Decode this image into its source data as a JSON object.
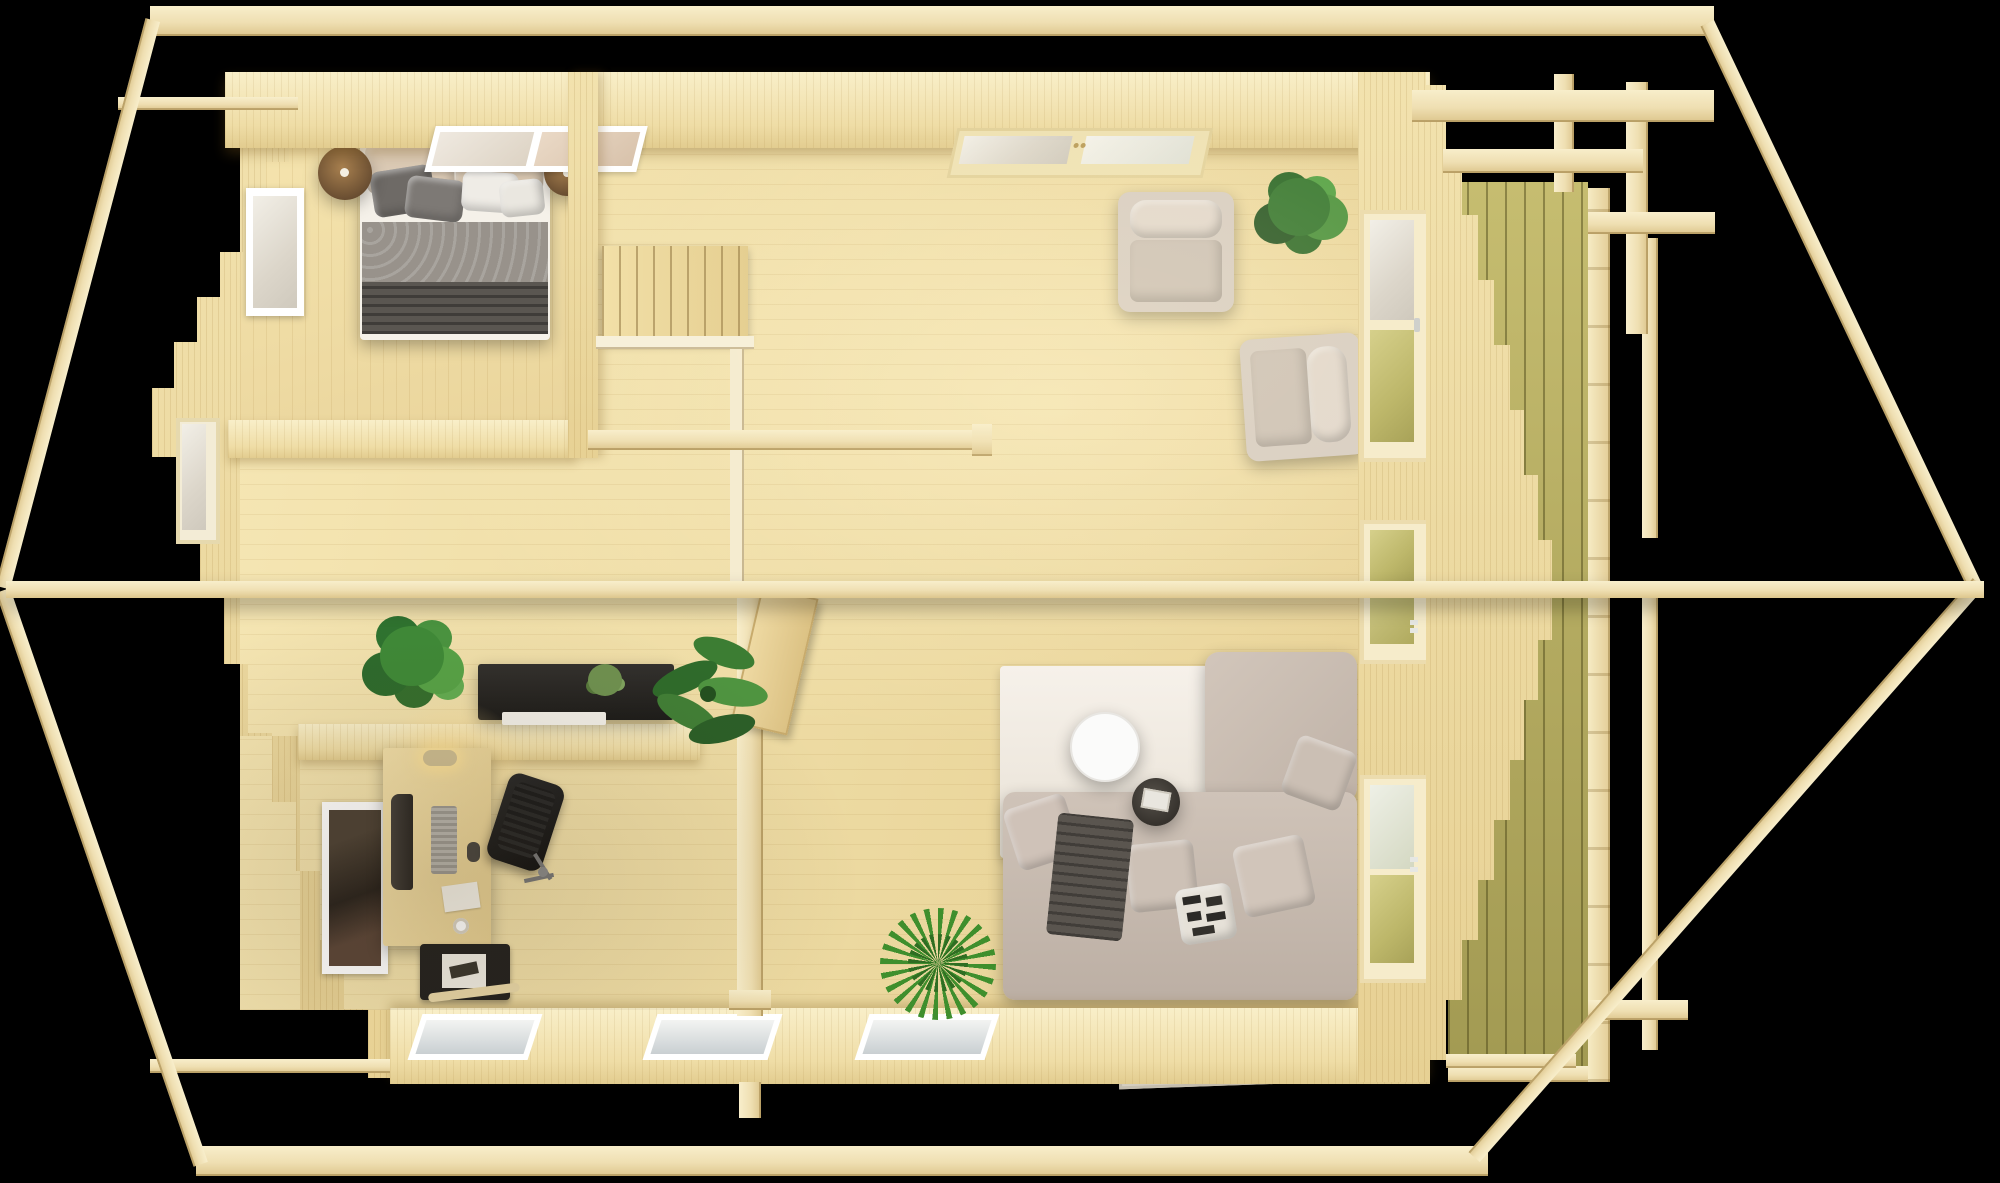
{
  "scene": {
    "title": "Top-down 3D render of a roofless wooden log cabin floor plan on a black background",
    "background_color": "#000000",
    "palette": {
      "roof_beam": "#f2e3bb",
      "wall_face": "#eedca4",
      "wall_top": "#f6ebc4",
      "floor_light": "#f6e7b5",
      "floor_dark": "#e6cf92",
      "terrace_deck_green": "#b9b164",
      "window_frame_white": "#ffffff",
      "sofa_greige": "#c9bcb1",
      "console_black": "#262626",
      "plant_green": "#3f8a38"
    },
    "rooms": {
      "bedroom": {
        "label": "Bedroom with double bed, two bedside pendant lamps, roof window"
      },
      "hallway": {
        "label": "Hallway with staircase, console sideboard and plants"
      },
      "office": {
        "label": "Home office with desk, monitor, lamp, office chair, magazine rack"
      },
      "living": {
        "label": "Living room with L-shaped sofa, rug, coffee table, two armchairs"
      },
      "terrace": {
        "label": "Covered terrace with green decking and pergola railing"
      }
    },
    "structure": {
      "roof_frame": {
        "label": "Exposed roof frame: ridge beam through the middle, top and bottom eave beams, diagonal gable rafters"
      },
      "west_gable": {
        "label": "Stepped log gable wall (left)"
      },
      "east_gable": {
        "label": "Stepped log gable wall (right, beside terrace)"
      },
      "north_wall": {
        "label": "Top wall with two double-pane windows"
      },
      "south_wall": {
        "label": "Bottom wall with three glazed windows"
      },
      "east_wall": {
        "label": "Right wall with three glazed terrace doors"
      },
      "ridge_beam": {
        "label": "Ridge beam"
      },
      "stairs": {
        "label": "Staircase with white railing",
        "steps": 8
      },
      "mid_post": {
        "label": "Support post between hallway and living room"
      },
      "interior_door": {
        "label": "Open interior wooden door"
      }
    },
    "furniture": {
      "bed": {
        "label": "Double bed with beige, grey and white pillows, patterned grey blanket and dark throw",
        "blanket": "#9b958e",
        "throw": "#57534e",
        "pillows": [
          "#d9c9b4",
          "#6e6a66",
          "#efece6"
        ]
      },
      "lamp_left": {
        "label": "Bronze pendant bedside lamp (left)"
      },
      "lamp_right": {
        "label": "Bronze pendant bedside lamp (right)"
      },
      "console": {
        "label": "Black console sideboard with white tray and small plant"
      },
      "desk": {
        "label": "Office desk with curved monitor, keyboard, mouse and lit desk lamp"
      },
      "office_chair": {
        "label": "Black swivel office chair"
      },
      "magazine_rack": {
        "label": "Black magazine rack below desk"
      },
      "sofa": {
        "label": "Greige L-shaped sofa with scatter cushions, graphic black-white pillow and grey throw"
      },
      "rug": {
        "label": "Large off-white area rug"
      },
      "coffee_table": {
        "label": "Round white coffee table"
      },
      "side_table": {
        "label": "Round dark side table with magazine"
      },
      "armchair_1": {
        "label": "Cream armchair (upper)"
      },
      "armchair_2": {
        "label": "Cream armchair (lower)"
      },
      "doormat": {
        "label": "Printed doormat at bottom wall"
      }
    },
    "plants": {
      "fiddle": {
        "label": "Fiddle-leaf fig beside console"
      },
      "banana": {
        "label": "Banana plant beside partition"
      },
      "grass": {
        "label": "Spiky grass plant near sofa"
      },
      "living_plant": {
        "label": "Potted plant between armchairs"
      },
      "console_plant": {
        "label": "Small plant on console"
      }
    }
  }
}
